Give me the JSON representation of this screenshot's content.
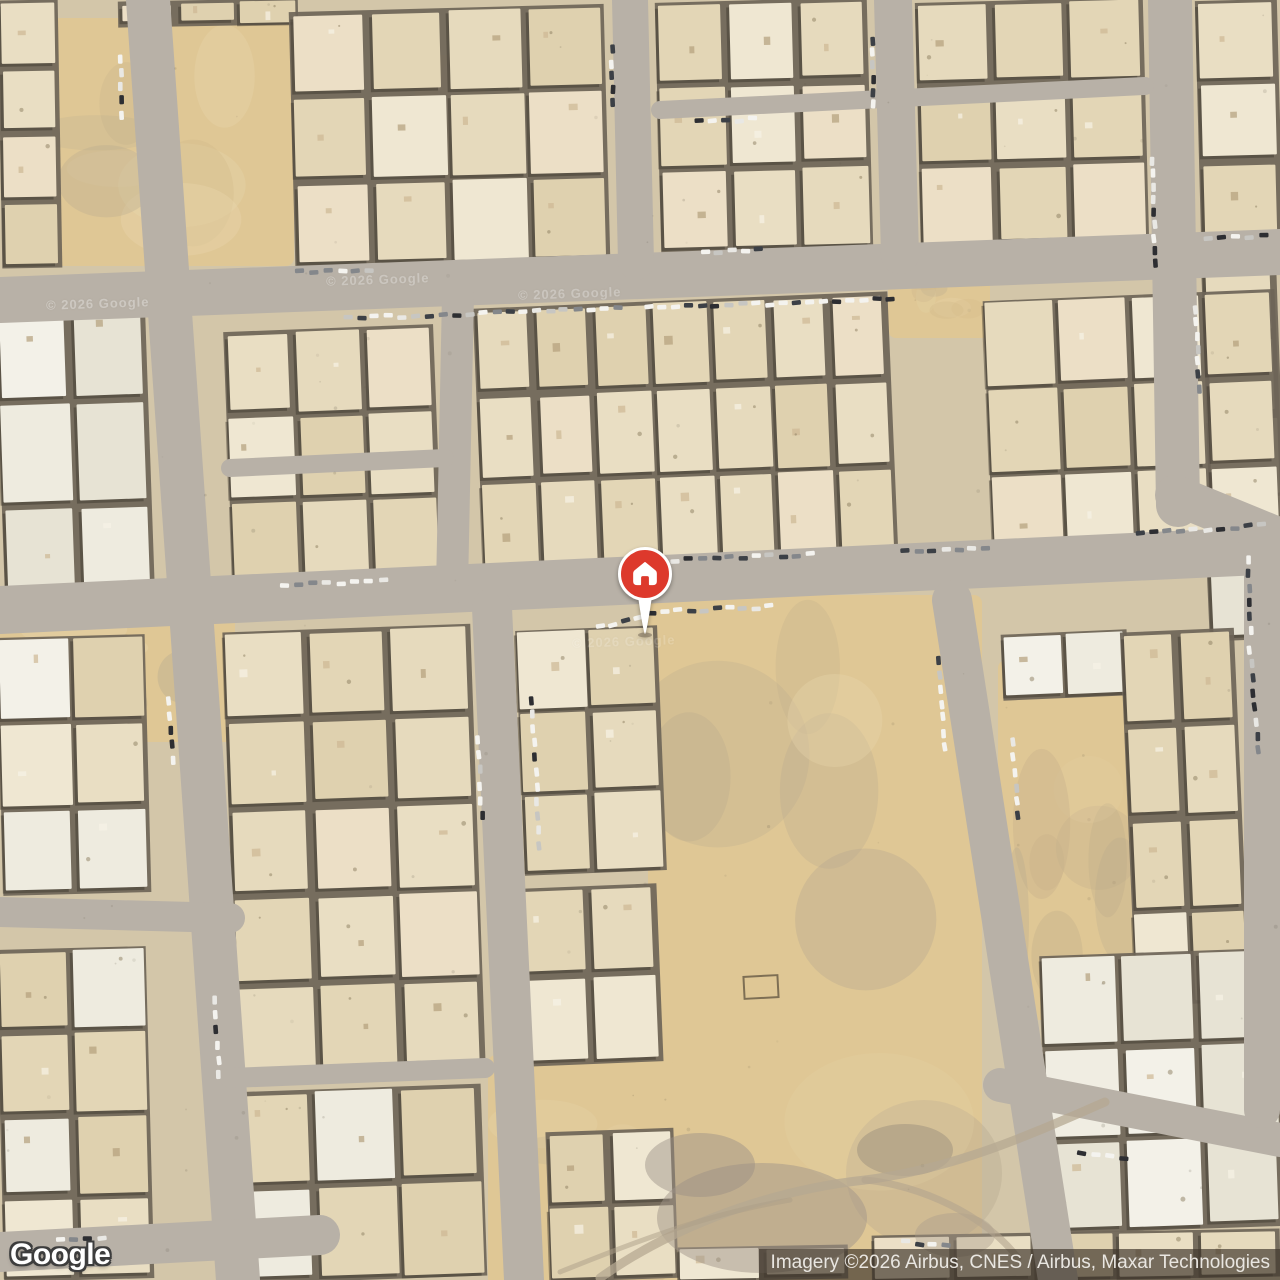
{
  "branding": {
    "logo_text": "Google"
  },
  "attribution": {
    "text": "Imagery ©2026 Airbus, CNES / Airbus, Maxar Technologies"
  },
  "marker": {
    "kind": "saved-home-place",
    "x": 645,
    "y": 574,
    "color": "#dd392c",
    "ring": "#ffffff",
    "icon": "house-icon"
  },
  "map": {
    "view": "satellite",
    "colors": {
      "base": "#d3c6a9",
      "blockBase": "#6e6558",
      "road": "#b8b1a7",
      "sand": "#dfc795",
      "sandBlobs": [
        "#d2b888",
        "#e9d7ae",
        "#c3ae8a",
        "#b5a88f"
      ],
      "shadow": "#3a342b",
      "detail": [
        "#cdb894",
        "#f6f2e6",
        "#b3a07c"
      ],
      "palettes": {
        "tan": [
          "#e9dec3",
          "#e3d6b6",
          "#efe7d2",
          "#dfd1af",
          "#ecdfc6",
          "#e6dabd"
        ],
        "white": [
          "#eeebdf",
          "#f3f1e8",
          "#e7e3d4",
          "#f0ede2"
        ],
        "mixed": [
          "#e9dec3",
          "#efe7d2",
          "#f3f1e8",
          "#e3d6b6",
          "#eeebdf",
          "#dfd1af"
        ]
      },
      "cars": [
        "#f4f3ef",
        "#2d2e32",
        "#c7c6c2",
        "#84878b",
        "#f4f3ef",
        "#3c4046",
        "#e9e8e4",
        "#f4f3ef"
      ]
    },
    "sand_lots": [
      {
        "x": 52,
        "y": 18,
        "w": 242,
        "h": 248
      },
      {
        "x": 415,
        "y": 55,
        "w": 70,
        "h": 185
      },
      {
        "x": 888,
        "y": 250,
        "w": 102,
        "h": 88
      },
      {
        "x": 994,
        "y": 322,
        "w": 132,
        "h": 148
      },
      {
        "x": 648,
        "y": 595,
        "w": 334,
        "h": 685
      },
      {
        "x": 998,
        "y": 660,
        "w": 145,
        "h": 360
      },
      {
        "x": 0,
        "y": 612,
        "w": 235,
        "h": 130
      },
      {
        "x": 282,
        "y": 638,
        "w": 78,
        "h": 122
      },
      {
        "x": 488,
        "y": 1055,
        "w": 185,
        "h": 235
      },
      {
        "x": 243,
        "y": 1118,
        "w": 64,
        "h": 162
      }
    ],
    "blocks": [
      {
        "x": 0,
        "y": 0,
        "w": 60,
        "h": 268,
        "cols": 1,
        "rows": 4,
        "rot": -1,
        "palette": "tan"
      },
      {
        "x": 118,
        "y": 0,
        "w": 180,
        "h": 26,
        "cols": 3,
        "rows": 1,
        "rot": -1,
        "palette": "tan"
      },
      {
        "x": 292,
        "y": 8,
        "w": 315,
        "h": 255,
        "cols": 4,
        "rows": 3,
        "rot": -1.5,
        "palette": "tan"
      },
      {
        "x": 658,
        "y": 0,
        "w": 212,
        "h": 250,
        "cols": 3,
        "rows": 3,
        "rot": -1.5,
        "palette": "tan"
      },
      {
        "x": 918,
        "y": 0,
        "w": 228,
        "h": 245,
        "cols": 3,
        "rows": 3,
        "rot": -1.5,
        "palette": "tan"
      },
      {
        "x": 1198,
        "y": 0,
        "w": 82,
        "h": 242,
        "cols": 1,
        "rows": 3,
        "rot": -1.5,
        "palette": "tan"
      },
      {
        "x": 1205,
        "y": 255,
        "w": 75,
        "h": 242,
        "cols": 1,
        "rows": 3,
        "rot": -2,
        "palette": "tan"
      },
      {
        "x": 0,
        "y": 298,
        "w": 150,
        "h": 310,
        "cols": 2,
        "rows": 3,
        "rot": -2,
        "palette": "white"
      },
      {
        "x": 228,
        "y": 328,
        "w": 210,
        "h": 255,
        "cols": 3,
        "rows": 3,
        "rot": -2.2,
        "palette": "tan"
      },
      {
        "x": 478,
        "y": 300,
        "w": 415,
        "h": 262,
        "cols": 7,
        "rows": 3,
        "rot": -2.4,
        "palette": "tan"
      },
      {
        "x": 988,
        "y": 295,
        "w": 292,
        "h": 262,
        "cols": 4,
        "rows": 3,
        "rot": -2.4,
        "palette": "tan"
      },
      {
        "x": 1208,
        "y": 556,
        "w": 72,
        "h": 84,
        "cols": 1,
        "rows": 1,
        "rot": -2.5,
        "palette": "white"
      },
      {
        "x": 0,
        "y": 636,
        "w": 148,
        "h": 258,
        "cols": 2,
        "rows": 3,
        "rot": -1.5,
        "palette": "mixed"
      },
      {
        "x": 0,
        "y": 948,
        "w": 150,
        "h": 332,
        "cols": 2,
        "rows": 4,
        "rot": -1.5,
        "palette": "mixed"
      },
      {
        "x": 230,
        "y": 628,
        "w": 248,
        "h": 442,
        "cols": 3,
        "rows": 5,
        "rot": -2,
        "palette": "tan"
      },
      {
        "x": 232,
        "y": 1088,
        "w": 252,
        "h": 192,
        "cols": 3,
        "rows": 2,
        "rot": -2,
        "palette": "mixed"
      },
      {
        "x": 520,
        "y": 628,
        "w": 142,
        "h": 245,
        "cols": 2,
        "rows": 3,
        "rot": -2.3,
        "palette": "tan"
      },
      {
        "x": 522,
        "y": 886,
        "w": 138,
        "h": 178,
        "cols": 2,
        "rows": 2,
        "rot": -2.3,
        "palette": "tan"
      },
      {
        "x": 548,
        "y": 1130,
        "w": 128,
        "h": 150,
        "cols": 2,
        "rows": 2,
        "rot": -2,
        "palette": "tan"
      },
      {
        "x": 1002,
        "y": 632,
        "w": 126,
        "h": 66,
        "cols": 2,
        "rows": 1,
        "rot": -2.5,
        "palette": "white"
      },
      {
        "x": 1128,
        "y": 630,
        "w": 114,
        "h": 374,
        "cols": 2,
        "rows": 4,
        "rot": -2.5,
        "palette": "tan"
      },
      {
        "x": 1044,
        "y": 952,
        "w": 236,
        "h": 278,
        "cols": 3,
        "rows": 3,
        "rot": -2,
        "palette": "white"
      },
      {
        "x": 872,
        "y": 1232,
        "w": 408,
        "h": 48,
        "cols": 5,
        "rows": 1,
        "rot": -1,
        "palette": "tan"
      },
      {
        "x": 678,
        "y": 1246,
        "w": 170,
        "h": 34,
        "cols": 2,
        "rows": 1,
        "rot": -1,
        "palette": "tan"
      }
    ],
    "roads": [
      [
        0,
        300,
        1280,
        252,
        46
      ],
      [
        0,
        610,
        1280,
        550,
        48
      ],
      [
        148,
        0,
        238,
        1280,
        44
      ],
      [
        458,
        295,
        452,
        588,
        32
      ],
      [
        492,
        608,
        524,
        1280,
        40
      ],
      [
        630,
        0,
        636,
        262,
        36
      ],
      [
        893,
        0,
        900,
        255,
        38
      ],
      [
        1170,
        0,
        1178,
        505,
        44
      ],
      [
        1175,
        495,
        1280,
        538,
        40
      ],
      [
        952,
        600,
        1058,
        1280,
        40
      ],
      [
        1000,
        1085,
        1280,
        1140,
        34
      ],
      [
        0,
        1252,
        320,
        1235,
        40
      ],
      [
        660,
        110,
        1145,
        86,
        18
      ],
      [
        230,
        468,
        445,
        458,
        18
      ],
      [
        0,
        912,
        230,
        918,
        30
      ],
      [
        230,
        1078,
        485,
        1068,
        20
      ],
      [
        1262,
        540,
        1262,
        1110,
        36
      ]
    ],
    "dirt_blobs": [
      {
        "cx": 762,
        "cy": 1218,
        "rx": 105,
        "ry": 55,
        "c": "#a1968a",
        "op": 0.5
      },
      {
        "cx": 700,
        "cy": 1165,
        "rx": 55,
        "ry": 32,
        "c": "#998f84",
        "op": 0.45
      },
      {
        "cx": 905,
        "cy": 1150,
        "rx": 48,
        "ry": 26,
        "c": "#8e8478",
        "op": 0.4
      },
      {
        "cx": 955,
        "cy": 1235,
        "rx": 40,
        "ry": 22,
        "c": "#a89c8b",
        "op": 0.4
      }
    ],
    "dirt_tracks": [
      {
        "d": "M600,1278 C660,1235 755,1192 865,1180 C960,1168 1040,1130 1105,1102",
        "w": 9,
        "op": 0.75,
        "c": "#b6a892"
      },
      {
        "d": "M865,1180 C920,1185 985,1215 1018,1258",
        "w": 7,
        "op": 0.6,
        "c": "#b2a48e"
      },
      {
        "d": "M560,1272 C620,1248 700,1215 790,1200",
        "w": 5,
        "op": 0.5,
        "c": "#ab9d88"
      }
    ],
    "plot_outline": {
      "x": 744,
      "y": 976,
      "w": 34,
      "h": 22,
      "rot": -3,
      "stroke": "#7e6f54"
    },
    "car_strips": [
      [
        348,
        318,
        -2,
        21,
        13.5
      ],
      [
        648,
        308,
        -2,
        19,
        13.5
      ],
      [
        300,
        272,
        -2,
        6,
        14
      ],
      [
        706,
        252,
        -2,
        5,
        13
      ],
      [
        1208,
        238,
        -2,
        5,
        14
      ],
      [
        1152,
        160,
        88,
        9,
        13
      ],
      [
        1196,
        310,
        88,
        7,
        13
      ],
      [
        872,
        40,
        89,
        6,
        13
      ],
      [
        612,
        50,
        89,
        5,
        13
      ],
      [
        120,
        58,
        88,
        5,
        14
      ],
      [
        285,
        585,
        -2.5,
        8,
        14
      ],
      [
        635,
        562,
        -2.5,
        14,
        13.5
      ],
      [
        905,
        551,
        -2.5,
        7,
        13.5
      ],
      [
        1140,
        534,
        -4,
        10,
        13.5
      ],
      [
        652,
        612,
        -2.5,
        10,
        13
      ],
      [
        600,
        627,
        -12,
        4,
        13
      ],
      [
        168,
        700,
        86,
        5,
        15
      ],
      [
        214,
        1000,
        86,
        6,
        15
      ],
      [
        532,
        700,
        87,
        11,
        14.5
      ],
      [
        478,
        740,
        87,
        6,
        15
      ],
      [
        938,
        660,
        85,
        7,
        14.5
      ],
      [
        1012,
        742,
        85,
        6,
        15
      ],
      [
        1248,
        560,
        88,
        6,
        14
      ],
      [
        1250,
        650,
        85,
        8,
        14.5
      ],
      [
        1082,
        1152,
        8,
        4,
        14
      ],
      [
        905,
        1242,
        5,
        4,
        14
      ],
      [
        60,
        1240,
        -3,
        4,
        14
      ],
      [
        700,
        122,
        -3,
        5,
        13
      ]
    ],
    "watermarks": [
      {
        "text": "© 2026 Google",
        "x": 46,
        "y": 296,
        "opacity": 0.3
      },
      {
        "text": "© 2026 Google",
        "x": 326,
        "y": 272,
        "opacity": 0.28
      },
      {
        "text": "© 2026 Google",
        "x": 518,
        "y": 286,
        "opacity": 0.26
      },
      {
        "text": "© 2026 Google",
        "x": 572,
        "y": 634,
        "opacity": 0.16
      }
    ]
  }
}
